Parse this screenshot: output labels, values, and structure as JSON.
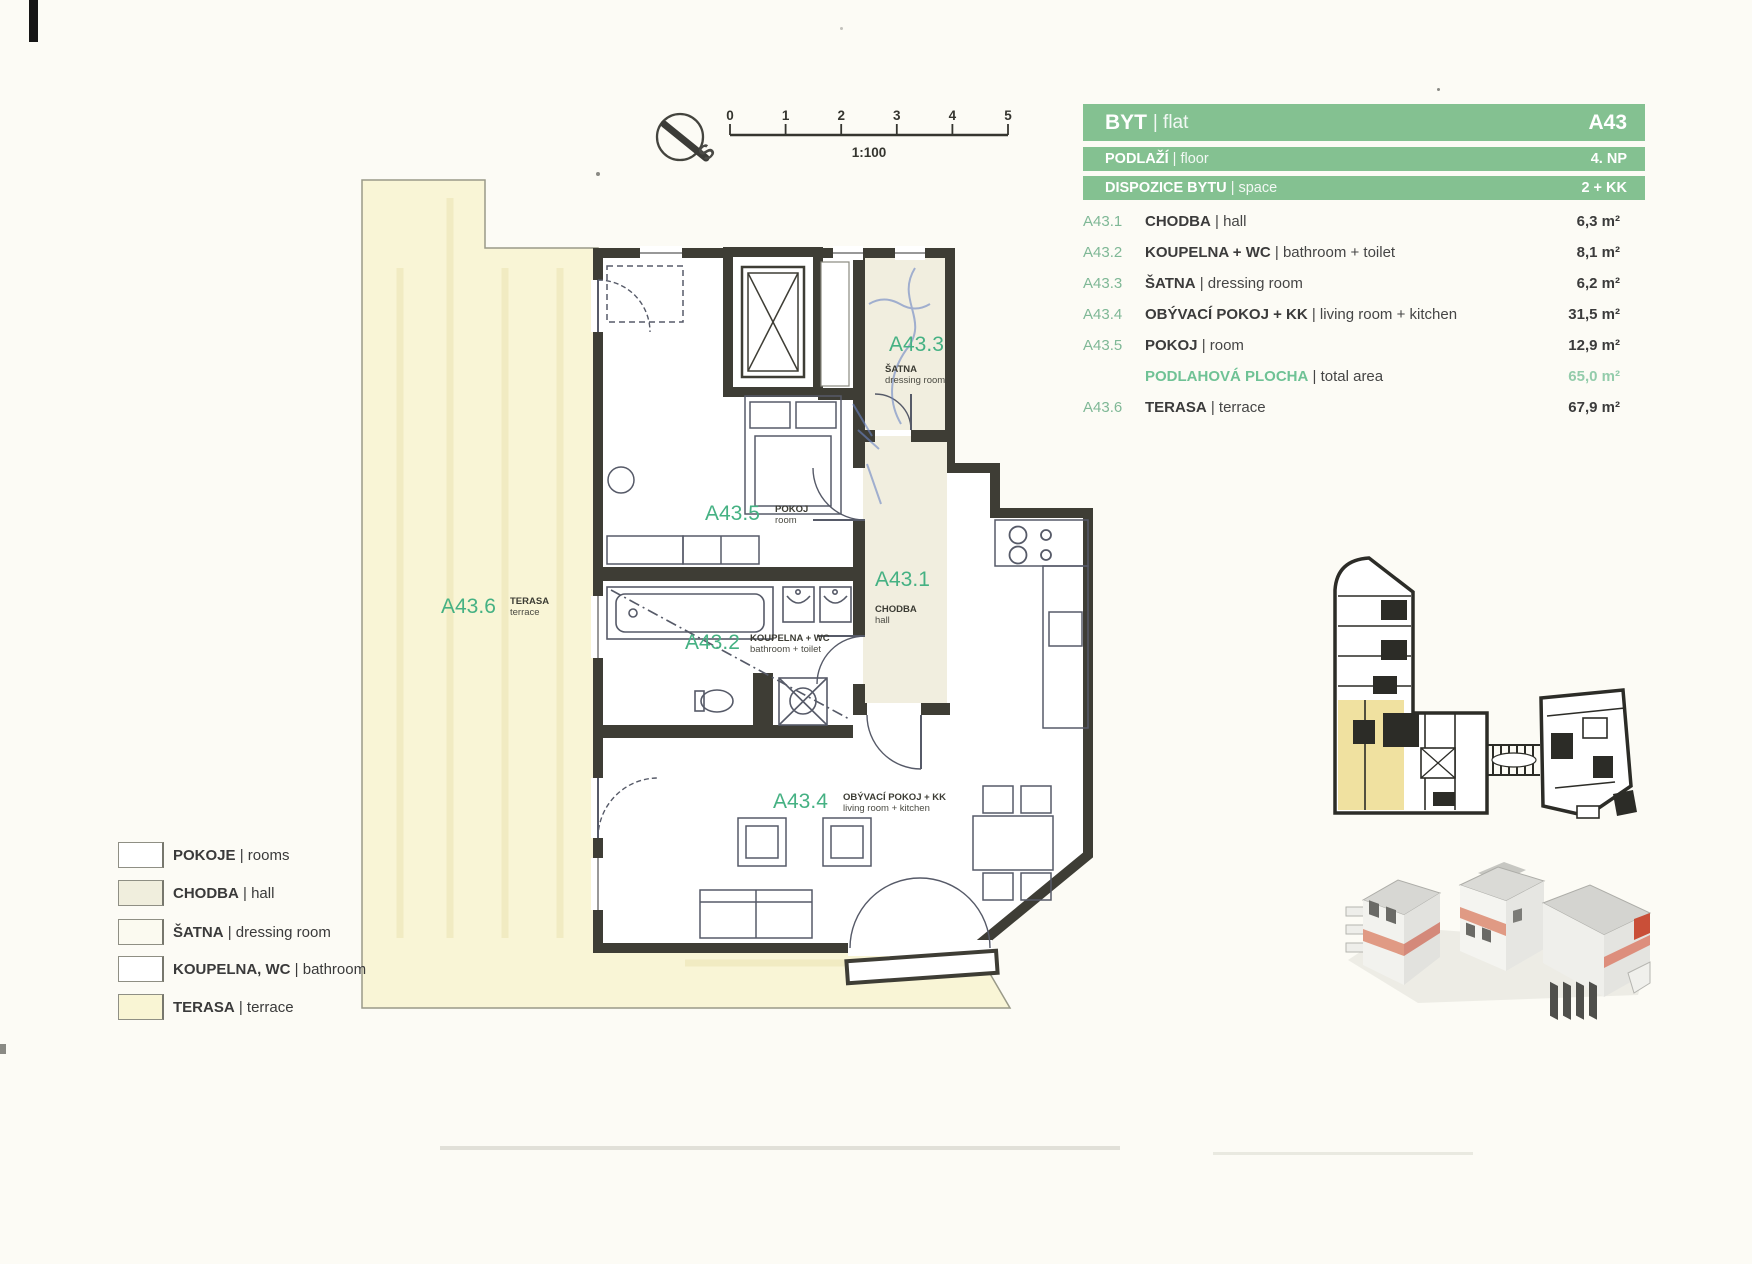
{
  "document": {
    "type": "floor-plan sheet"
  },
  "compass": {
    "label": "S"
  },
  "scale_bar": {
    "ticks": [
      "0",
      "1",
      "2",
      "3",
      "4",
      "5"
    ],
    "ratio": "1:100"
  },
  "info_table": {
    "accent_green": "#84c191",
    "rows": [
      {
        "cs": "BYT",
        "en": "| flat",
        "value": "A43"
      },
      {
        "cs": "PODLAŽÍ",
        "en": "| floor",
        "value": "4. NP"
      },
      {
        "cs": "DISPOZICE BYTU",
        "en": "| space",
        "value": "2 + KK"
      }
    ]
  },
  "room_list": [
    {
      "code": "A43.1",
      "cs": "CHODBA",
      "en": "| hall",
      "area": "6,3 m²"
    },
    {
      "code": "A43.2",
      "cs": "KOUPELNA + WC",
      "en": "| bathroom + toilet",
      "area": "8,1 m²"
    },
    {
      "code": "A43.3",
      "cs": "ŠATNA",
      "en": "| dressing room",
      "area": "6,2 m²"
    },
    {
      "code": "A43.4",
      "cs": "OBÝVACÍ POKOJ + KK",
      "en": "| living room + kitchen",
      "area": "31,5 m²"
    },
    {
      "code": "A43.5",
      "cs": "POKOJ",
      "en": "| room",
      "area": "12,9 m²"
    },
    {
      "code": "",
      "cs": "PODLAHOVÁ PLOCHA",
      "en": "| total area",
      "area": "65,0 m²"
    },
    {
      "code": "A43.6",
      "cs": "TERASA",
      "en": "| terrace",
      "area": "67,9 m²"
    }
  ],
  "plan_labels": [
    {
      "code": "A43.1",
      "name": "CHODBA",
      "sub": "hall"
    },
    {
      "code": "A43.2",
      "name": "KOUPELNA + WC",
      "sub": "bathroom + toilet"
    },
    {
      "code": "A43.3",
      "name": "ŠATNA",
      "sub": "dressing room"
    },
    {
      "code": "A43.4",
      "name": "OBÝVACÍ POKOJ + KK",
      "sub": "living room + kitchen"
    },
    {
      "code": "A43.5",
      "name": "POKOJ",
      "sub": "room"
    },
    {
      "code": "A43.6",
      "name": "TERASA",
      "sub": "terrace"
    }
  ],
  "legend": [
    {
      "cs": "POKOJE",
      "en": "| rooms",
      "swatch": "#ffffff"
    },
    {
      "cs": "CHODBA",
      "en": "| hall",
      "swatch": "#f0eedd"
    },
    {
      "cs": "ŠATNA",
      "en": "| dressing room",
      "swatch": "#fbfaf0"
    },
    {
      "cs": "KOUPELNA, WC",
      "en": "| bathroom",
      "swatch": "#ffffff"
    },
    {
      "cs": "TERASA",
      "en": "| terrace",
      "swatch": "#f9f5d4"
    }
  ],
  "colors": {
    "wall": "#3e3d35",
    "terrace_fill": "#f9f5d6",
    "hall_fill": "#f1eedf",
    "label_green": "#45b183",
    "site_highlight": "#f0e1a0",
    "render_band": "#e09a84"
  }
}
